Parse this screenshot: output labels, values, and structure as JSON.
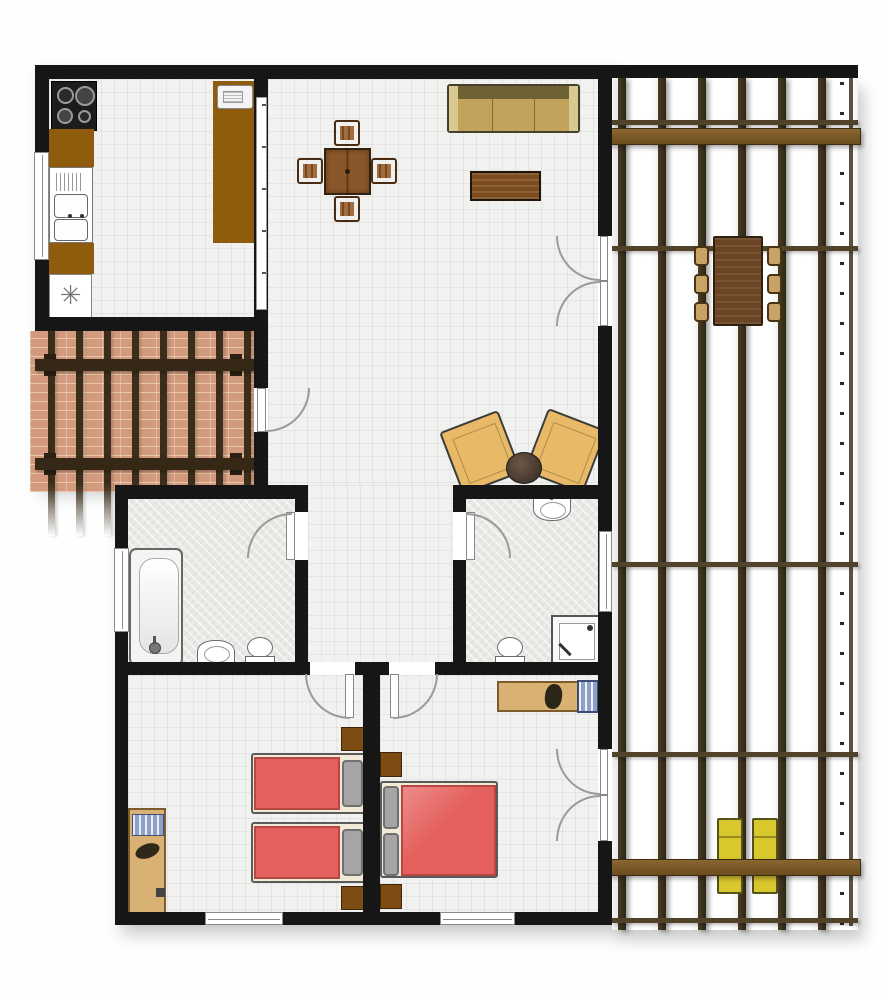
{
  "title": "apartment-floor-plan",
  "palette": {
    "wall": "#161616",
    "floor_tile": "#f1f1f0",
    "floor_grid": "rgba(0,0,0,0.05)",
    "bath_tile": "#e9e9e6",
    "brick": "#d39b7d",
    "brick_line": "#eac6ab",
    "rail": "#51422a",
    "patio_beam": "#352817",
    "counter": "#8f5c0d",
    "wood_table": "#8a572b",
    "wood_chair": "#a46b3c",
    "outdoor_chair": "#c9a266",
    "sofa_seat": "#c2a35c",
    "sofa_back": "#6e6134",
    "sofa_arm": "#d9c88f",
    "coffee_table": "#7b4b1e",
    "armchair": "#e8ba67",
    "side_table": "#46362a",
    "bed_red": "#e4605c",
    "bed_red_border": "#b84744",
    "pillow": "#a5a5a5",
    "bed_frame": "#f1ead6",
    "nightstand": "#7c4c12",
    "desk": "#d9b173",
    "lounger": "#d9c72e",
    "fixture_white": "#ffffff",
    "fixture_border": "#6b6b6b",
    "door_line": "#9a9a9a",
    "blue_item": "#8ca0c8",
    "appliance_dark": "#1c1c1c"
  },
  "icons": {
    "fridge_symbol": "✳"
  },
  "rooms": [
    {
      "name": "kitchen",
      "features": [
        "stove-4-burner",
        "counter",
        "double-sink",
        "refrigerator",
        "tall-cabinet",
        "microwave",
        "pass-through",
        "window"
      ]
    },
    {
      "name": "living-dining-room",
      "features": [
        "square-dining-table",
        "4-chairs",
        "3-seat-sofa",
        "coffee-table",
        "2-armchairs",
        "round-side-table",
        "door-to-patio",
        "french-door-to-deck"
      ]
    },
    {
      "name": "patio",
      "features": [
        "brick-floor",
        "pergola-posts",
        "2-cross-beams"
      ]
    },
    {
      "name": "bathroom-1",
      "features": [
        "bathtub",
        "washbasin",
        "toilet",
        "window",
        "door"
      ]
    },
    {
      "name": "hallway",
      "features": [
        "door-to-bedroom-1",
        "door-to-bedroom-2"
      ]
    },
    {
      "name": "bathroom-2",
      "features": [
        "washbasin",
        "toilet",
        "corner-shower",
        "window",
        "door"
      ]
    },
    {
      "name": "bedroom-1",
      "features": [
        "twin-bed-1",
        "twin-bed-2",
        "2-nightstands",
        "desk",
        "window"
      ]
    },
    {
      "name": "bedroom-2",
      "features": [
        "double-bed",
        "2-nightstands",
        "desk",
        "desk-chair",
        "blue-cabinet",
        "french-door-to-deck",
        "window"
      ]
    },
    {
      "name": "pergola-deck",
      "features": [
        "6-posts",
        "cross-rails",
        "2-brown-beams",
        "outdoor-dining-table",
        "6-outdoor-chairs",
        "2-sun-loungers"
      ]
    }
  ]
}
